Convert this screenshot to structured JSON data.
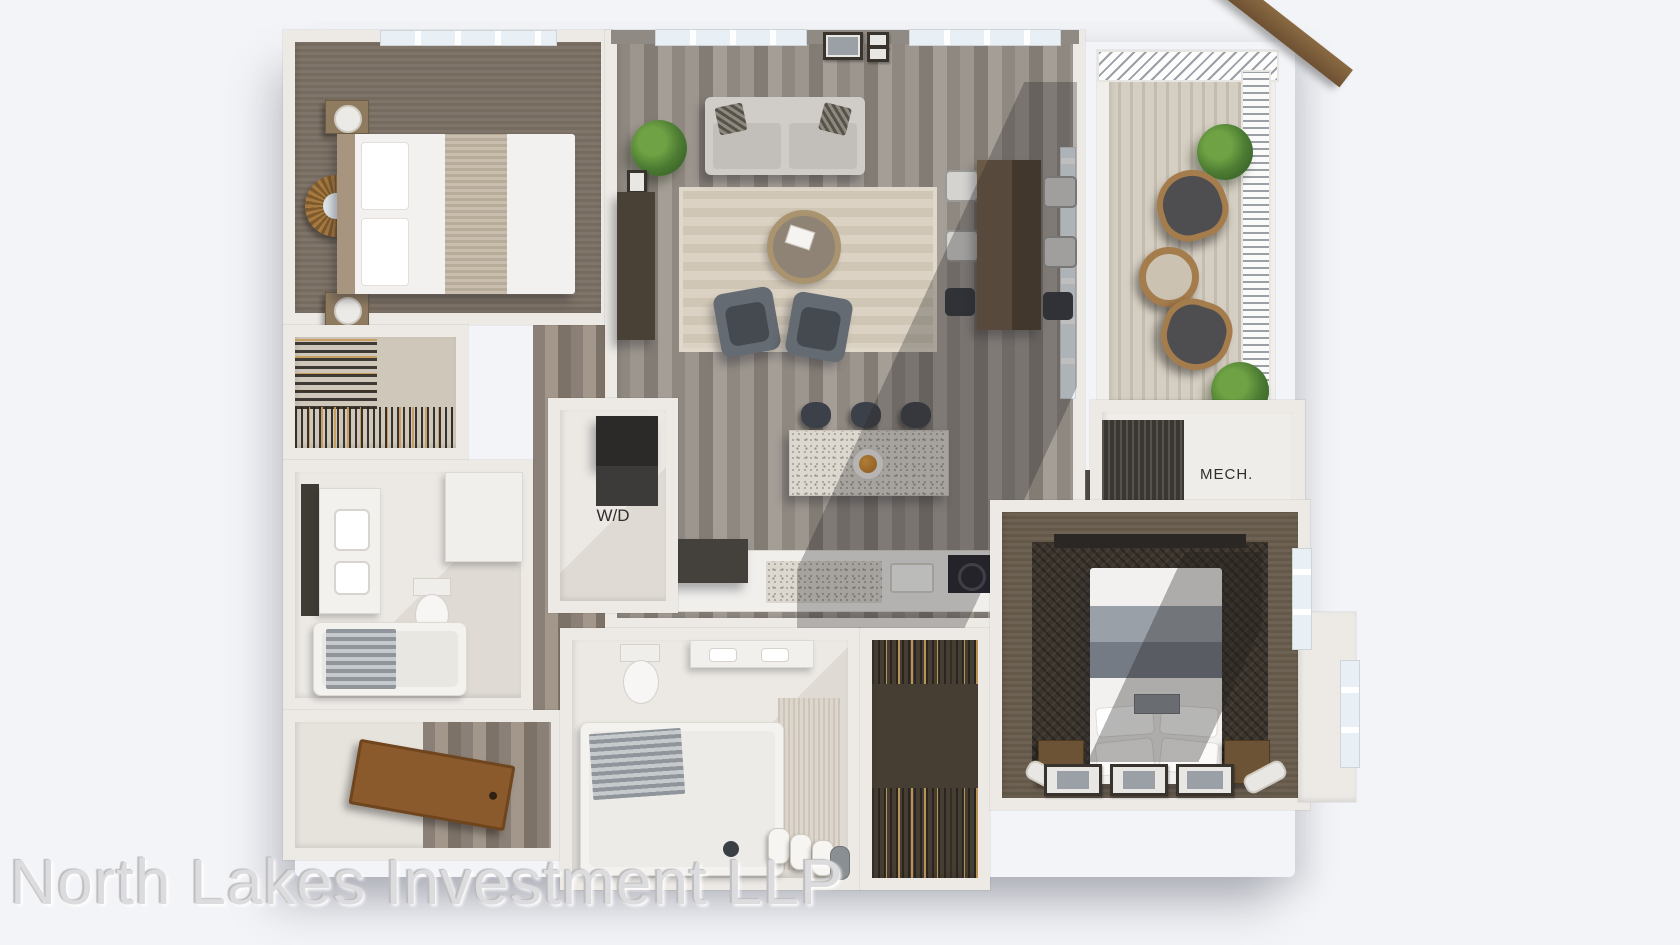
{
  "watermark": {
    "text": "North Lakes Investment LLP"
  },
  "labels": {
    "mech": "MECH.",
    "washer_dryer": "W/D"
  },
  "colors": {
    "bg": "#f3f4f7",
    "wall": "#edeae6",
    "wall_edge": "#d8d4cf",
    "wood": "#98918a",
    "wood_dark": "#5f5b56",
    "carpet_warm": "#7e7365",
    "carpet_dark": "#6e6254",
    "rug_dark": "#3b342c",
    "tile": "#e9e6e1",
    "terrazzo": "#dcd8d0",
    "rug_living": "#d8cfc0",
    "sofa": "#d0cdc9",
    "furniture_dark": "#44484f",
    "chair_dark": "#33373d",
    "wood_furniture": "#5d4c3a",
    "console": "#4a4136",
    "wicker": "#a57c4c",
    "plant": "#4d7c33",
    "door": "#8a5a2c",
    "accent_wall": "#908a84",
    "window_pane": "#e8f0f5",
    "watermark": "#dcdcde",
    "label_text": "#2e2e2e",
    "towel": "#959ba1",
    "bedding": "#f2f1ef",
    "bedding_gray": "#79808a",
    "appliance": "#2c2a28",
    "balcony_floor": "#d2cbbf",
    "closet_floor": "#473e33"
  }
}
